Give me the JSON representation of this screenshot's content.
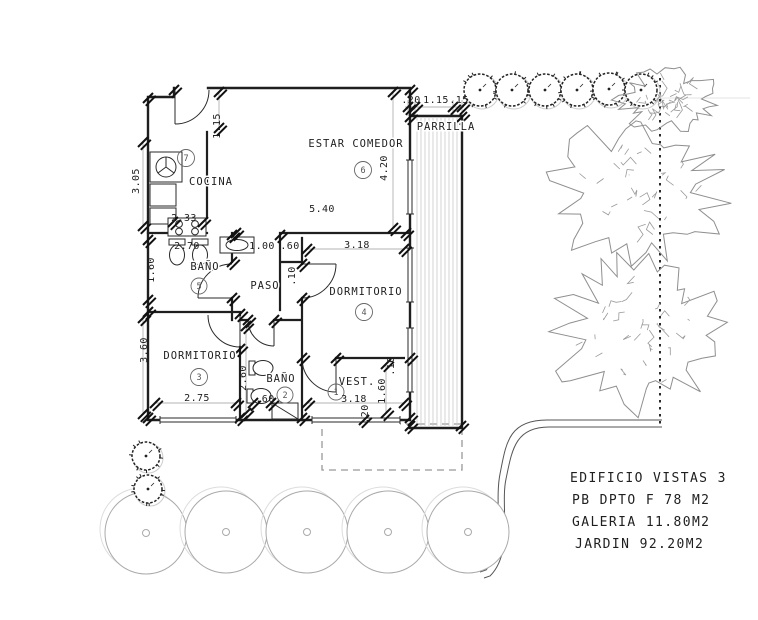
{
  "plan": {
    "rooms": {
      "cocina": {
        "label": "COCINA",
        "number": "7"
      },
      "estar": {
        "label": "ESTAR COMEDOR",
        "number": "6"
      },
      "bano5": {
        "label": "BAÑO",
        "number": "5"
      },
      "paso": {
        "label": "PASO"
      },
      "dorm4": {
        "label": "DORMITORIO",
        "number": "4"
      },
      "dorm3": {
        "label": "DORMITORIO",
        "number": "3"
      },
      "bano2": {
        "label": "BAÑO",
        "number": "2"
      },
      "vest": {
        "label": "VEST.",
        "number": "1"
      },
      "parrilla": {
        "label": "PARRILLA"
      }
    },
    "dimensions": {
      "cocina_115": "1.15",
      "top_20": ".20",
      "top_115": "1.15",
      "top_15": ".15",
      "estar_h": "4.20",
      "estar_w": "5.40",
      "cocina_h": "3.05",
      "cocina_w": "2.33",
      "bano5_w": "2.70",
      "bano5_h": "1.60",
      "paso_100": "1.00",
      "paso_60": ".60",
      "paso_10": ".10",
      "dorm4_w": "3.18",
      "dorm3_h": "3.60",
      "dorm3_w": "2.75",
      "bano2_h": "2.60",
      "bano2_60": ".60",
      "vest_w": "3.18",
      "vest_h": "1.60",
      "vest_10": ".10",
      "vest_20": ".20"
    }
  },
  "title_block": {
    "line1": "EDIFICIO VISTAS 3",
    "line2": "PB DPTO F 78 M2",
    "line3": "GALERIA 11.80M2",
    "line4": "JARDIN 92.20M2"
  }
}
